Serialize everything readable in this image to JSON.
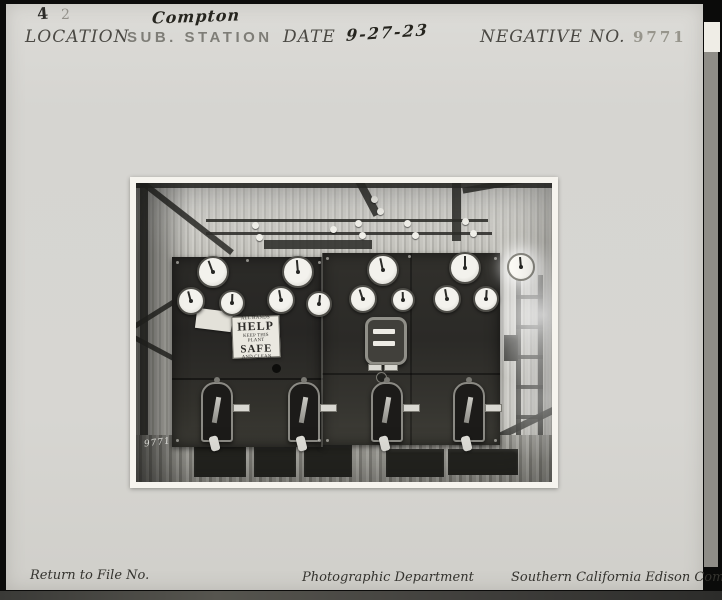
{
  "card": {
    "stamps": {
      "left_mark": "4",
      "right_mark": "2"
    },
    "header": {
      "location_label": "LOCATION",
      "location_value_handwritten": "Compton",
      "location_value_stamped": "SUB. STATION",
      "date_label": "DATE",
      "date_value_handwritten": "9-27-23",
      "negative_label": "NEGATIVE NO.",
      "negative_value": "9771"
    },
    "footer": {
      "return_label": "Return to File No.",
      "department": "Photographic Department",
      "company": "Southern California Edison Company"
    },
    "colors": {
      "card_bg": "#d7d6d2",
      "frame": "#0b0b0a",
      "stamp_ink": "#75746d",
      "caption_ink": "#4a4843"
    }
  },
  "photo": {
    "description": "Interior of substation: two dark switchboard panels with round meters and switch handles on a corrugated-iron wall",
    "safety_sign": {
      "line1": "ALL HANDS",
      "line2": "HELP",
      "line3": "KEEP THIS PLANT",
      "line4": "SAFE",
      "line5": "AND CLEAN"
    },
    "negative_scratch_mark": "9771",
    "meter_count": 13,
    "switch_count": 4
  }
}
